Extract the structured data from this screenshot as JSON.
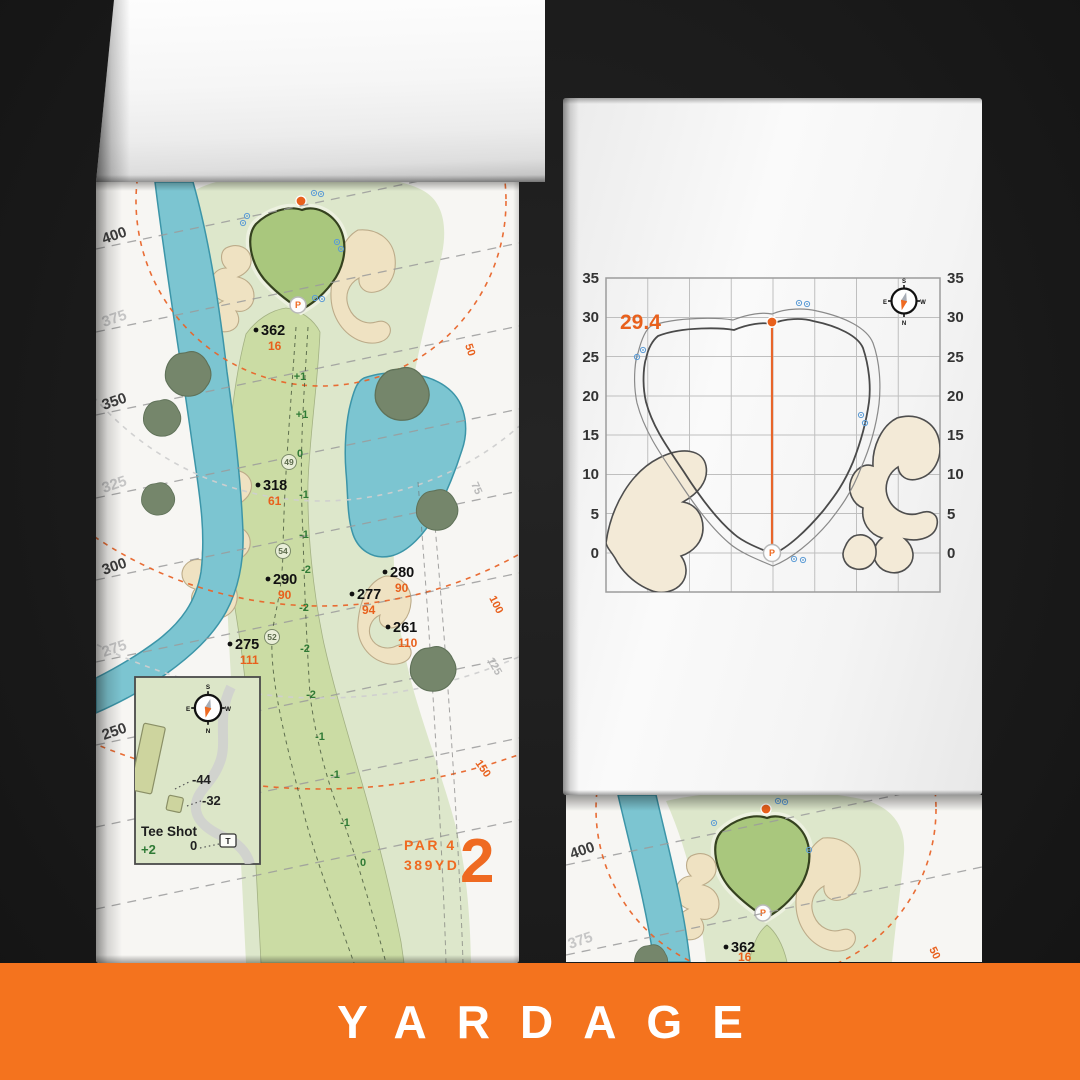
{
  "banner": {
    "label": "YARDAGE"
  },
  "glyphs": {
    "pin_flag": "P",
    "tee_marker": "T"
  },
  "compass": {
    "n": "N",
    "s": "S",
    "e": "E",
    "w": "W"
  },
  "colors": {
    "banner_bg": "#F4731E",
    "accent_orange": "#E8601C",
    "hole_number_orange": "#EF6A21",
    "water": "#7CC5D1",
    "green_fill": "#A9C77D",
    "fairway": "#CBDCA4",
    "rough": "#DDE7CB",
    "bunker": "#EFE2C2",
    "tree": "#75866B",
    "slope_green": "#2F7A35",
    "backdrop": "#1B1B1B"
  },
  "left_page": {
    "hole": {
      "number": "2",
      "par": "PAR 4",
      "yards": "389YD"
    },
    "yardage_lines": [
      {
        "label": "400",
        "tone": "dark"
      },
      {
        "label": "375",
        "tone": "light"
      },
      {
        "label": "350",
        "tone": "dark"
      },
      {
        "label": "325",
        "tone": "light"
      },
      {
        "label": "300",
        "tone": "dark"
      },
      {
        "label": "275",
        "tone": "light"
      },
      {
        "label": "250",
        "tone": "dark"
      }
    ],
    "distance_rings": [
      {
        "label": "50",
        "tone": "accent"
      },
      {
        "label": "75",
        "tone": "light"
      },
      {
        "label": "100",
        "tone": "accent"
      },
      {
        "label": "125",
        "tone": "light"
      },
      {
        "label": "150",
        "tone": "accent"
      }
    ],
    "carry_markers": [
      {
        "dist": "362",
        "to_front": "16"
      },
      {
        "dist": "318",
        "to_front": "61"
      },
      {
        "dist": "290",
        "to_front": "90"
      },
      {
        "dist": "280",
        "to_front": "90"
      },
      {
        "dist": "277",
        "to_front": "94"
      },
      {
        "dist": "261",
        "to_front": "110"
      },
      {
        "dist": "275",
        "to_front": "111"
      }
    ],
    "slope_numbers": [
      "+1",
      "+1",
      "0",
      "-1",
      "-1",
      "-2",
      "-2",
      "-2",
      "-2",
      "-1",
      "-1",
      "-1",
      "0"
    ],
    "layup_circles": [
      "49",
      "54",
      "52"
    ],
    "tee_inset": {
      "title": "Tee Shot",
      "elevation": "+2",
      "carries": [
        "-44",
        "-32",
        "0"
      ]
    }
  },
  "right_page": {
    "green_chart": {
      "type": "green-depth-grid",
      "depth_value": "29.4",
      "tick_step": 5,
      "grid_columns": 8,
      "y_ticks": [
        "35",
        "30",
        "25",
        "20",
        "15",
        "10",
        "5",
        "0"
      ]
    },
    "preview": {
      "yardage_lines": [
        {
          "label": "400",
          "tone": "dark"
        },
        {
          "label": "375",
          "tone": "light"
        }
      ],
      "carry_marker": {
        "dist": "362",
        "to_front": "16"
      },
      "ring_label": "50"
    }
  }
}
